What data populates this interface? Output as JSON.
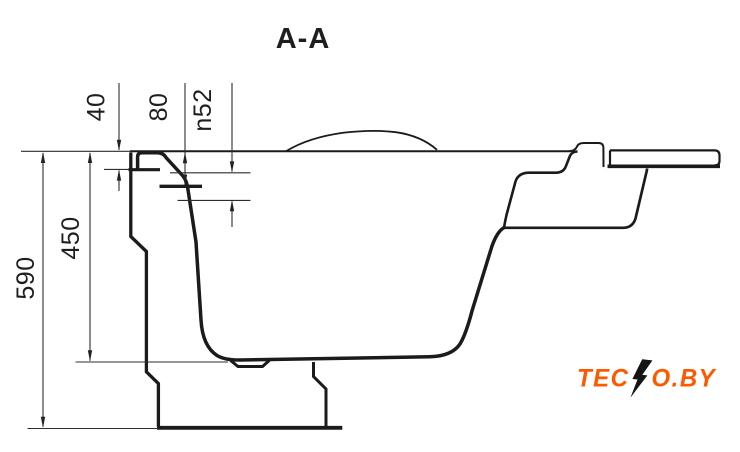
{
  "title": "A-A",
  "dimensions": {
    "rim_thickness": "40",
    "overflow_offset": "80",
    "overflow_diameter": "n52",
    "inner_depth": "450",
    "total_height": "590"
  },
  "logo": {
    "text_left": "TEC",
    "text_right": "O.BY",
    "color_orange": "#ff5900",
    "color_black": "#141414"
  },
  "colors": {
    "profile_line": "#1b1b1b",
    "dimension_line": "#2d2d2d",
    "background": "#ffffff"
  }
}
